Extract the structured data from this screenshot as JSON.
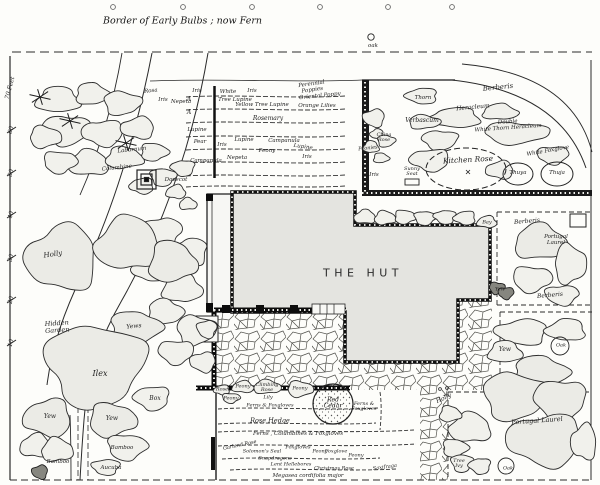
{
  "page": {
    "title": "Border of Early Bulbs ; now Fern"
  },
  "building": {
    "label": "THE HUT"
  },
  "scale": {
    "unit": "70 Feet",
    "ticks": [
      "60",
      "50",
      "40",
      "30",
      "20",
      "10"
    ]
  },
  "labels": [
    {
      "name": "label-oak-top",
      "text": "oak",
      "x": 373,
      "y": 47,
      "fs": 5.5
    },
    {
      "name": "label-rosa",
      "text": "Rosa",
      "x": 151,
      "y": 92,
      "fs": 5.5,
      "rot": -6
    },
    {
      "name": "label-iris-a",
      "text": "Iris",
      "x": 163,
      "y": 101,
      "fs": 5.5
    },
    {
      "name": "label-nepeta-a",
      "text": "Nepeta",
      "x": 181,
      "y": 103,
      "fs": 5.5
    },
    {
      "name": "label-iris-1",
      "text": "Iris",
      "x": 197,
      "y": 92,
      "fs": 5.5
    },
    {
      "name": "label-marker-a1",
      "text": "A",
      "x": 189,
      "y": 100,
      "fs": 6
    },
    {
      "name": "label-marker-a2",
      "text": "A",
      "x": 189,
      "y": 113,
      "fs": 6
    },
    {
      "name": "label-white",
      "text": "White",
      "x": 228,
      "y": 93,
      "fs": 5.5
    },
    {
      "name": "label-iris-2",
      "text": "Iris",
      "x": 252,
      "y": 92,
      "fs": 5.5
    },
    {
      "name": "label-perennial-poppies",
      "text": "Perennial\nPoppies",
      "x": 312,
      "y": 88,
      "fs": 5.5,
      "rot": -8
    },
    {
      "name": "label-tree-lupine",
      "text": "Tree Lupine",
      "x": 235,
      "y": 101,
      "fs": 5.5
    },
    {
      "name": "label-yellow-tree-lupine",
      "text": "Yellow Tree Lupine",
      "x": 262,
      "y": 106,
      "fs": 5.5
    },
    {
      "name": "label-oriental-poppy",
      "text": "Oriental Poppy",
      "x": 320,
      "y": 97,
      "fs": 5.5,
      "rot": -6
    },
    {
      "name": "label-orange-lilies",
      "text": "Orange Lilies",
      "x": 317,
      "y": 107,
      "fs": 5.5
    },
    {
      "name": "label-rosemary",
      "text": "Rosemary",
      "x": 268,
      "y": 119,
      "fs": 6
    },
    {
      "name": "label-lupine-1",
      "text": "Lupine",
      "x": 197,
      "y": 131,
      "fs": 5.5
    },
    {
      "name": "label-pear",
      "text": "Pear",
      "x": 200,
      "y": 143,
      "fs": 5.5
    },
    {
      "name": "label-iris-3",
      "text": "Iris",
      "x": 222,
      "y": 146,
      "fs": 5.5
    },
    {
      "name": "label-lupine-2",
      "text": "Lupine",
      "x": 244,
      "y": 141,
      "fs": 5.5
    },
    {
      "name": "label-campanula-1",
      "text": "Campanula",
      "x": 284,
      "y": 142,
      "fs": 5.5
    },
    {
      "name": "label-peony-bed",
      "text": "Peony",
      "x": 267,
      "y": 152,
      "fs": 5.5
    },
    {
      "name": "label-lupine-3",
      "text": "Lupine",
      "x": 303,
      "y": 148,
      "fs": 5.5,
      "rot": 8
    },
    {
      "name": "label-iris-4",
      "text": "Iris",
      "x": 307,
      "y": 158,
      "fs": 5.5
    },
    {
      "name": "label-nepeta-b",
      "text": "Nepeta",
      "x": 237,
      "y": 159,
      "fs": 5.5
    },
    {
      "name": "label-campanula-2",
      "text": "Campanula",
      "x": 206,
      "y": 162,
      "fs": 5.5
    },
    {
      "name": "label-laburnum",
      "text": "Laburnum",
      "x": 132,
      "y": 151,
      "fs": 5.5,
      "rot": -6
    },
    {
      "name": "label-columbine",
      "text": "Columbine",
      "x": 117,
      "y": 169,
      "fs": 5.5,
      "rot": -6
    },
    {
      "name": "label-dovecot",
      "text": "Dovecot",
      "x": 176,
      "y": 181,
      "fs": 5.5
    },
    {
      "name": "label-holly-left",
      "text": "Holly",
      "x": 53,
      "y": 255,
      "fs": 7,
      "rot": -8
    },
    {
      "name": "label-hidden-garden",
      "text": "Hidden\nGarden",
      "x": 57,
      "y": 327,
      "fs": 6.5,
      "rot": -4
    },
    {
      "name": "label-yews",
      "text": "Yews",
      "x": 134,
      "y": 327,
      "fs": 6,
      "rot": -6
    },
    {
      "name": "label-ilex",
      "text": "Ilex",
      "x": 100,
      "y": 374,
      "fs": 8
    },
    {
      "name": "label-box",
      "text": "Box",
      "x": 155,
      "y": 399,
      "fs": 6
    },
    {
      "name": "label-yew-1",
      "text": "Yew",
      "x": 50,
      "y": 417,
      "fs": 6
    },
    {
      "name": "label-yew-2",
      "text": "Yew",
      "x": 112,
      "y": 419,
      "fs": 6
    },
    {
      "name": "label-bamboo-1",
      "text": "Bamboo",
      "x": 58,
      "y": 463,
      "fs": 5.5
    },
    {
      "name": "label-bamboo-2",
      "text": "Bamboo",
      "x": 122,
      "y": 449,
      "fs": 5.5
    },
    {
      "name": "label-aucuba",
      "text": "Aucuba",
      "x": 111,
      "y": 469,
      "fs": 5.5
    },
    {
      "name": "label-berberis-top",
      "text": "Berberis",
      "x": 498,
      "y": 88,
      "fs": 7,
      "rot": -6
    },
    {
      "name": "label-thorn",
      "text": "Thorn",
      "x": 423,
      "y": 99,
      "fs": 5.5
    },
    {
      "name": "label-heracleum",
      "text": "Heracleum",
      "x": 473,
      "y": 108,
      "fs": 6,
      "rot": -5
    },
    {
      "name": "label-verbascum",
      "text": "Verbascum",
      "x": 422,
      "y": 121,
      "fs": 6
    },
    {
      "name": "label-double-white-thorn",
      "text": "Double\nWhite Thorn Heracleum",
      "x": 508,
      "y": 126,
      "fs": 5.5,
      "rot": -4
    },
    {
      "name": "label-china-rose",
      "text": "China\nRose",
      "x": 384,
      "y": 138,
      "fs": 5
    },
    {
      "name": "label-peonies",
      "text": "Peonies",
      "x": 368,
      "y": 149,
      "fs": 5,
      "rot": -6
    },
    {
      "name": "label-iris-kitchen",
      "text": "Iris",
      "x": 374,
      "y": 176,
      "fs": 5.5
    },
    {
      "name": "label-sunny-seat",
      "text": "Sunny\nSeat",
      "x": 412,
      "y": 172,
      "fs": 5
    },
    {
      "name": "label-kitchen-rose",
      "text": "Kitchen Rose",
      "x": 468,
      "y": 160,
      "fs": 7.5,
      "rot": -3
    },
    {
      "name": "label-white-foxglove",
      "text": "White Foxglove",
      "x": 548,
      "y": 152,
      "fs": 5.5,
      "rot": -10
    },
    {
      "name": "label-thuya",
      "text": "Thuya",
      "x": 518,
      "y": 174,
      "fs": 5.5
    },
    {
      "name": "label-thuja",
      "text": "Thuja",
      "x": 557,
      "y": 174,
      "fs": 5.5
    },
    {
      "name": "label-bay",
      "text": "Bay",
      "x": 487,
      "y": 223,
      "fs": 5
    },
    {
      "name": "label-berberis-right-1",
      "text": "Berberis",
      "x": 527,
      "y": 222,
      "fs": 6,
      "rot": -5
    },
    {
      "name": "label-portugal-laurel-small",
      "text": "Portugal\nLaurel",
      "x": 556,
      "y": 241,
      "fs": 5.5
    },
    {
      "name": "label-berberis-right-2",
      "text": "Berberis",
      "x": 550,
      "y": 296,
      "fs": 6,
      "rot": -5
    },
    {
      "name": "label-yew-wall",
      "text": "Yew",
      "x": 500,
      "y": 290,
      "fs": 5
    },
    {
      "name": "label-yew-right",
      "text": "Yew",
      "x": 505,
      "y": 350,
      "fs": 6
    },
    {
      "name": "label-oak-right",
      "text": "Oak",
      "x": 561,
      "y": 346,
      "fs": 5
    },
    {
      "name": "label-holly-path",
      "text": "Holly",
      "x": 444,
      "y": 399,
      "fs": 6,
      "rot": -25
    },
    {
      "name": "label-portugal-laurel",
      "text": "Portugal Laurel",
      "x": 537,
      "y": 421,
      "fs": 6.5,
      "rot": -4
    },
    {
      "name": "label-tree-ivy",
      "text": "Tree\nIvy",
      "x": 459,
      "y": 464,
      "fs": 5
    },
    {
      "name": "label-oak-bottom",
      "text": "Oak",
      "x": 508,
      "y": 469,
      "fs": 5
    },
    {
      "name": "label-rose-bed",
      "text": "Rose",
      "x": 222,
      "y": 390,
      "fs": 5
    },
    {
      "name": "label-peony-1",
      "text": "Peony",
      "x": 243,
      "y": 387,
      "fs": 5
    },
    {
      "name": "label-climbing-rose",
      "text": "Climbing\nRose",
      "x": 267,
      "y": 388,
      "fs": 5
    },
    {
      "name": "label-peony-2",
      "text": "Peony",
      "x": 300,
      "y": 389,
      "fs": 5
    },
    {
      "name": "label-peony-3",
      "text": "Peony",
      "x": 231,
      "y": 399,
      "fs": 5
    },
    {
      "name": "label-lily",
      "text": "Lily",
      "x": 268,
      "y": 398,
      "fs": 5
    },
    {
      "name": "label-ferns-foxgloves-1",
      "text": "Ferns & Foxgloves",
      "x": 270,
      "y": 406,
      "fs": 5
    },
    {
      "name": "label-rose-hedge",
      "text": "Rose Hedge",
      "x": 270,
      "y": 421,
      "fs": 6.5
    },
    {
      "name": "label-red-cedar",
      "text": "Red\nCedar",
      "x": 333,
      "y": 404,
      "fs": 6
    },
    {
      "name": "label-ferns-foxgloves-2",
      "text": "Ferns &\nFoxgloves",
      "x": 364,
      "y": 407,
      "fs": 5
    },
    {
      "name": "label-ferns-columbines",
      "text": "Ferns , Columbines & Foxgloves",
      "x": 298,
      "y": 435,
      "fs": 5.5
    },
    {
      "name": "label-garland-rose",
      "text": "Garland Rose",
      "x": 240,
      "y": 446,
      "fs": 5,
      "rot": -12
    },
    {
      "name": "label-solomons-seal",
      "text": "Solomon's Seal",
      "x": 262,
      "y": 452,
      "fs": 5
    },
    {
      "name": "label-foxgloves-1",
      "text": "Foxgloves",
      "x": 298,
      "y": 448,
      "fs": 5
    },
    {
      "name": "label-peony-4",
      "text": "Peony",
      "x": 320,
      "y": 452,
      "fs": 5
    },
    {
      "name": "label-snapdragons",
      "text": "Snapdragons",
      "x": 275,
      "y": 459,
      "fs": 5
    },
    {
      "name": "label-foxglove-2",
      "text": "Foxglove",
      "x": 336,
      "y": 452,
      "fs": 5
    },
    {
      "name": "label-peony-5",
      "text": "Peony",
      "x": 356,
      "y": 456,
      "fs": 5
    },
    {
      "name": "label-lent-hellebores",
      "text": "Lent Hellebores",
      "x": 291,
      "y": 465,
      "fs": 5
    },
    {
      "name": "label-christmas-rose",
      "text": "Christmas Rose",
      "x": 334,
      "y": 469,
      "fs": 5
    },
    {
      "name": "label-saxifraga",
      "text": "Saxifraga",
      "x": 385,
      "y": 468,
      "fs": 5,
      "rot": -8
    },
    {
      "name": "label-megasea",
      "text": "Megasea cordifolia major",
      "x": 308,
      "y": 477,
      "fs": 5.5
    }
  ]
}
